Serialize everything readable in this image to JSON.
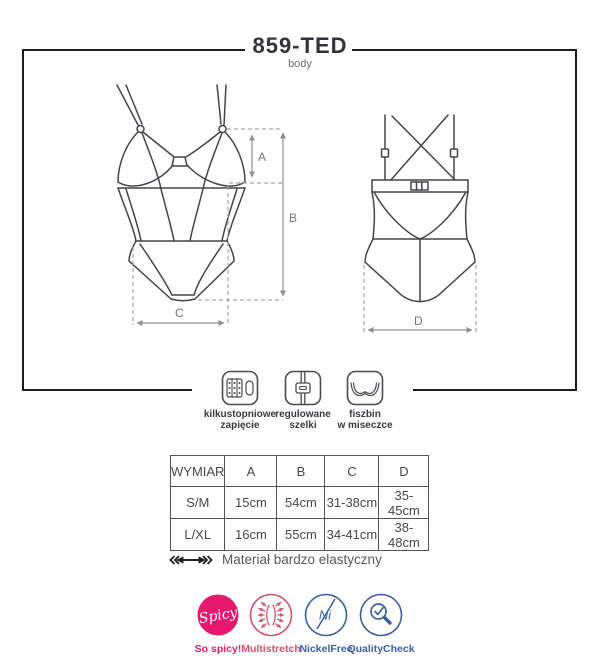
{
  "title": {
    "model": "859-TED",
    "subtitle": "body"
  },
  "diagram": {
    "dim_labels": {
      "a": "A",
      "b": "B",
      "c": "C",
      "d": "D"
    },
    "views": [
      "front-bodysuit-sketch",
      "back-bodysuit-sketch"
    ]
  },
  "features": [
    {
      "icon": "hook-closure-icon",
      "label_line1": "kilkustopniowe",
      "label_line2": "zapięcie"
    },
    {
      "icon": "adjustable-strap-icon",
      "label_line1": "regulowane",
      "label_line2": "szelki"
    },
    {
      "icon": "underwire-cup-icon",
      "label_line1": "fiszbin",
      "label_line2": "w miseczce"
    }
  ],
  "size_table": {
    "headers": [
      "WYMIAR",
      "A",
      "B",
      "C",
      "D"
    ],
    "rows": [
      [
        "S/M",
        "15cm",
        "54cm",
        "31-38cm",
        "35-45cm"
      ],
      [
        "L/XL",
        "16cm",
        "55cm",
        "34-41cm",
        "38-48cm"
      ]
    ]
  },
  "material_note": {
    "icon": "stretch-arrow-icon",
    "text": "Materiał bardzo elastyczny"
  },
  "badges": [
    {
      "name": "so-spicy",
      "icon_text": "Spicy",
      "label": "So spicy!",
      "color": "#e6196e"
    },
    {
      "name": "multistretch",
      "icon_text": "",
      "label": "Multistretch",
      "color": "#d6506b"
    },
    {
      "name": "nickel-free",
      "icon_text": "Ni",
      "label": "NickelFree",
      "color": "#3a5fa9"
    },
    {
      "name": "quality-check",
      "icon_text": "",
      "label": "QualityCheck",
      "color": "#3a5fa9"
    }
  ],
  "colors": {
    "frame": "#1c1c1c",
    "sketch_line": "#44444d",
    "dimension_line": "#8f8f97",
    "pink": "#e6196e",
    "rose": "#d6506b",
    "blue": "#3a5fa9"
  }
}
